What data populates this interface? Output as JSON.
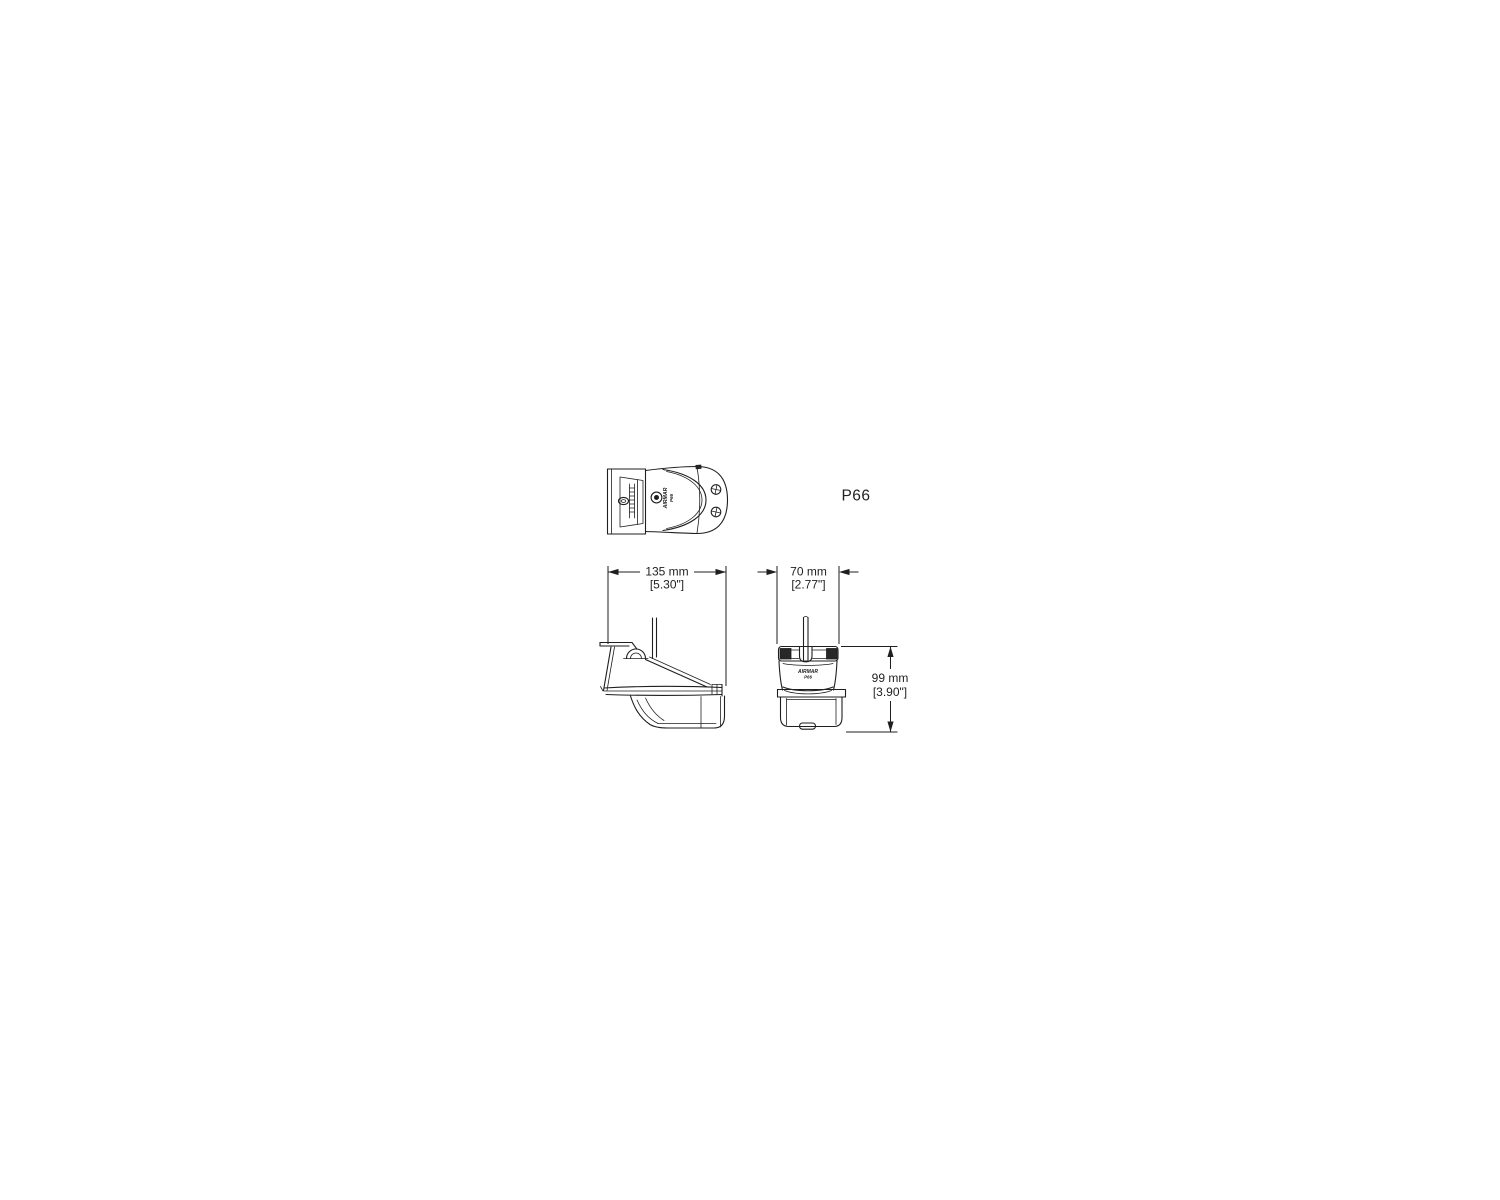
{
  "canvas": {
    "background": "#ffffff",
    "line_color": "#1f1f1f"
  },
  "product_label": "P66",
  "brand_logo": {
    "line1": "AIRMAR",
    "line2": "P66"
  },
  "dimensions": {
    "width": {
      "metric": "135 mm",
      "imperial": "[5.30\"]"
    },
    "depth": {
      "metric": "70 mm",
      "imperial": "[2.77\"]"
    },
    "height": {
      "metric": "99 mm",
      "imperial": "[3.90\"]"
    }
  }
}
